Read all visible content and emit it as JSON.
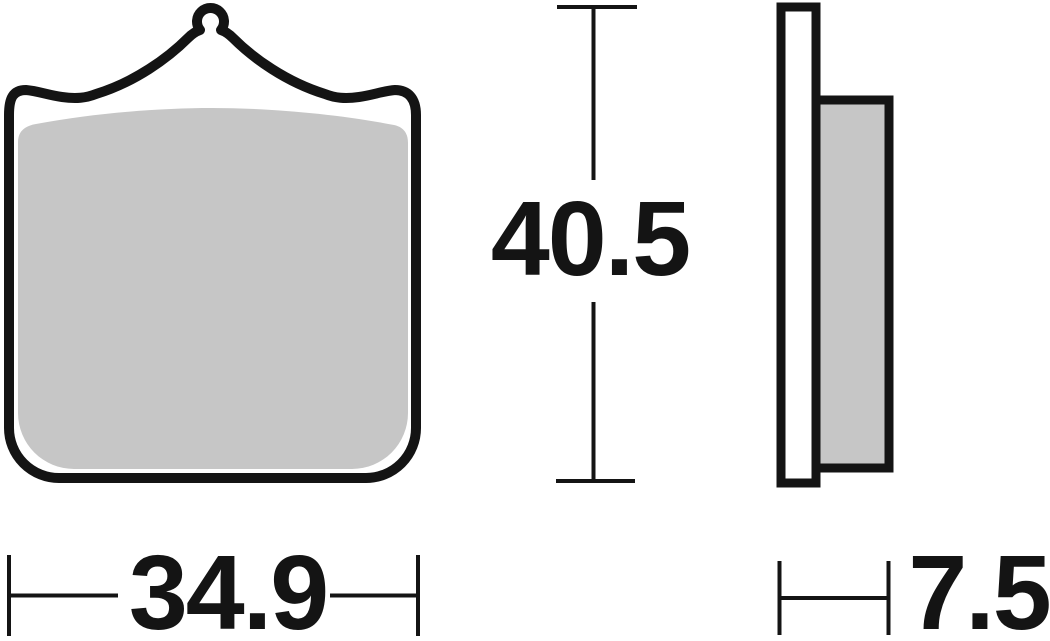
{
  "figure": {
    "type": "technical-dimension-drawing",
    "subject": "brake-pad",
    "dimensions": {
      "width": "34.9",
      "height": "40.5",
      "thickness": "7.5"
    },
    "colors": {
      "line": "#141414",
      "friction_fill": "#c6c6c6",
      "plate_fill": "#ffffff",
      "background": "#ffffff"
    }
  }
}
